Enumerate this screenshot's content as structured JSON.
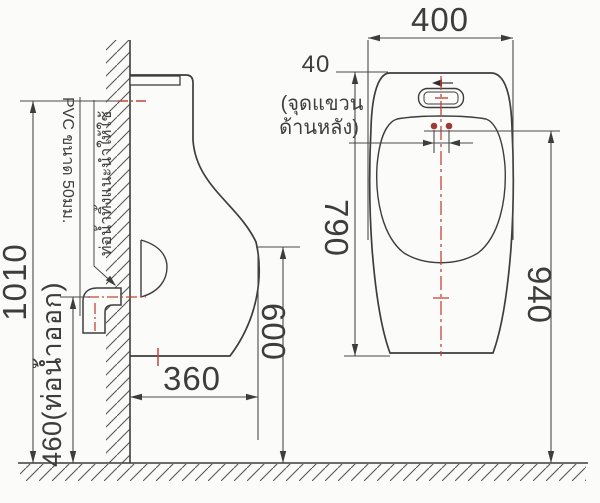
{
  "colors": {
    "line": "#3d3d3d",
    "dim_line": "#4a4a4a",
    "centerline_red": "#c8423a",
    "hang_dot_red": "#9c3a34",
    "background": "#fbfbfa"
  },
  "side_view": {
    "dims": {
      "overall_height": "1010",
      "outlet_height": "460(ท่อน้ำออก)",
      "depth": "360",
      "rim_height": "600"
    },
    "pipe_note": {
      "line1": "ท่อน้ำทิ้งแนะนำให้ใช้",
      "line2": "PVC ขนาด 50มม."
    }
  },
  "front_view": {
    "dims": {
      "width": "400",
      "hang_hole_spacing": "40",
      "body_height": "790",
      "hang_height": "940"
    },
    "hang_note": {
      "line1": "(จุดแขวน",
      "line2": "ด้านหลัง)"
    }
  }
}
